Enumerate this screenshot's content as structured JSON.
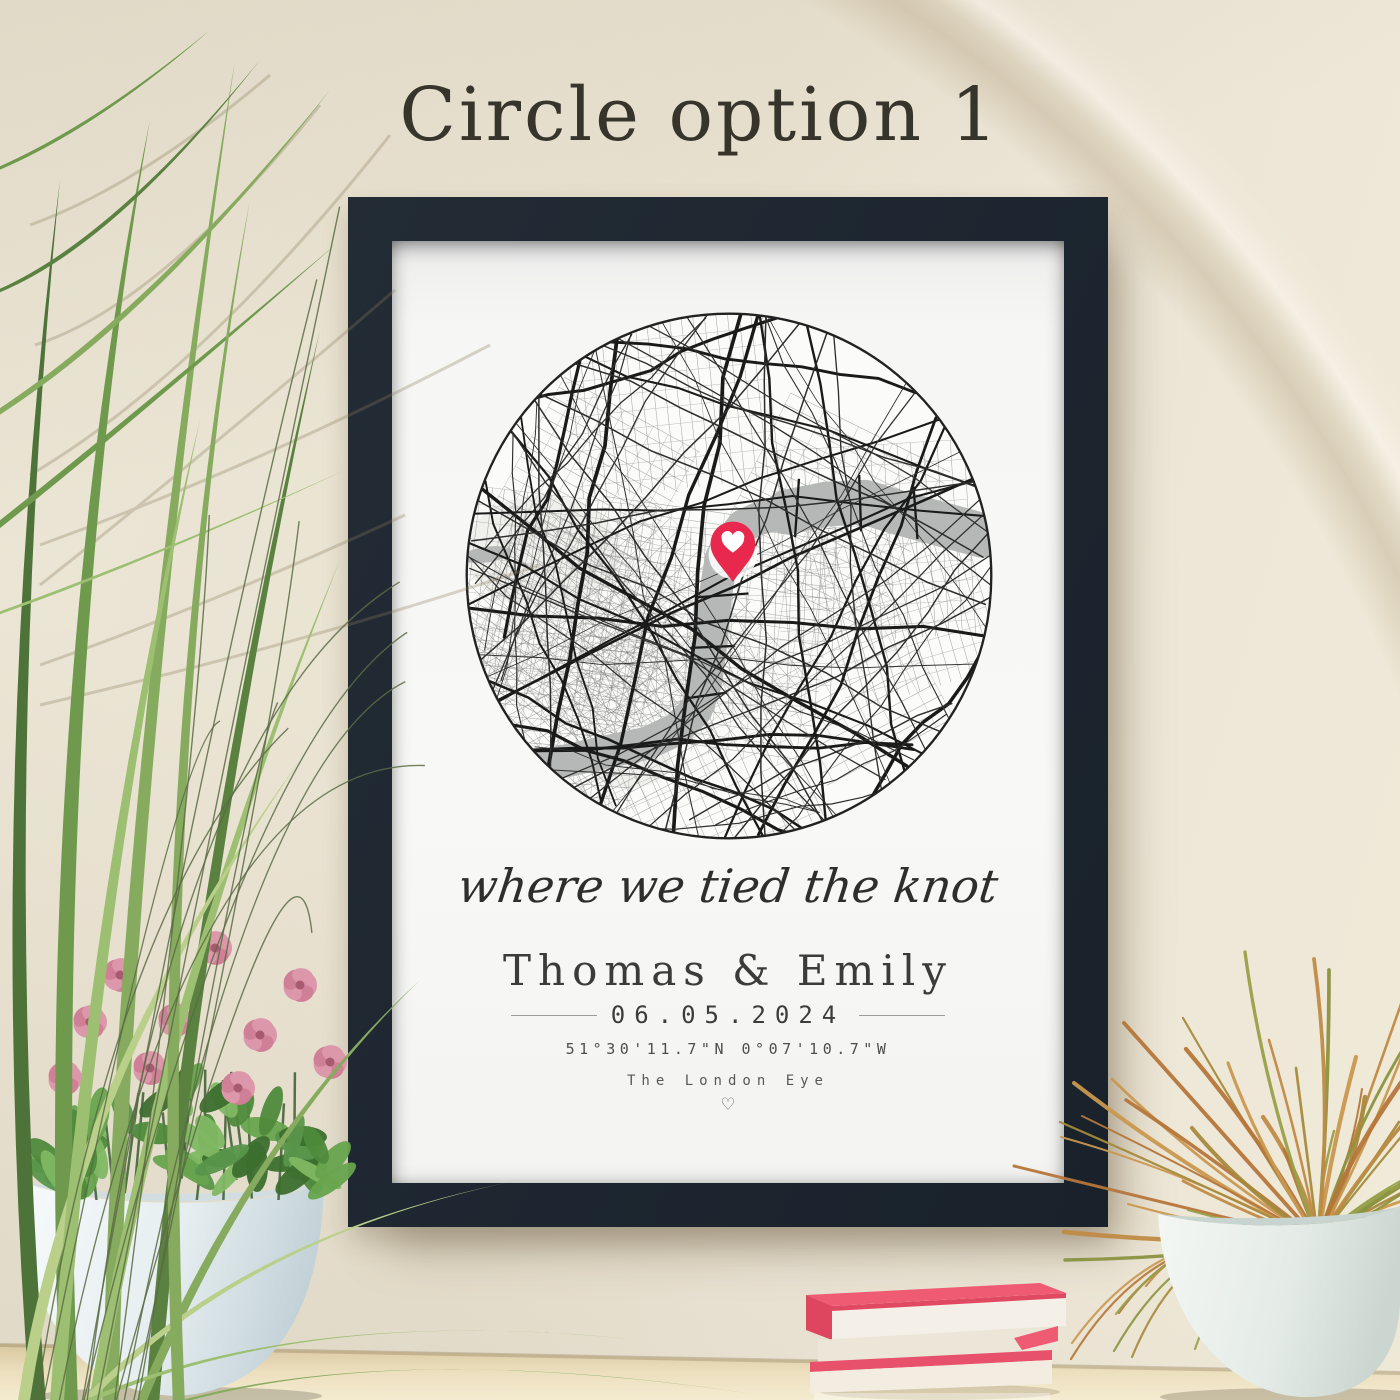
{
  "heading": {
    "label": "Circle option 1"
  },
  "poster": {
    "script_line": "where we tied the knot",
    "names": "Thomas & Emily",
    "date": "06.05.2024",
    "coordinates": "51°30'11.7\"N  0°07'10.7\"W",
    "location": "The London Eye",
    "heart_glyph": "♡"
  },
  "map": {
    "type": "street-map-circle",
    "pin_icon": "heart-location-pin",
    "seedless_label": "",
    "river_present": true
  },
  "colors": {
    "frame": "#1f2831",
    "mat": "#f7f6f3",
    "pin": "#e8294d",
    "pinheart": "#ffffff",
    "river": "#b5b8b6",
    "street": "#1a1a1a",
    "mapbg": "#fbfbf9",
    "mapline": "#222222",
    "wall": "#eae3d3",
    "table": "#e6d8b4",
    "book": "#e85268",
    "pages": "#f3efe5",
    "pot": "#e9f0f1",
    "flower": "#cf7f96",
    "leaf": "#5f9443",
    "grass1": "#6f9a4e",
    "grass2": "#86ab5e",
    "grass3": "#9dbf72",
    "grass4": "#5a8140",
    "grass5": "#b9cf8a",
    "grass6": "#4d7338"
  }
}
